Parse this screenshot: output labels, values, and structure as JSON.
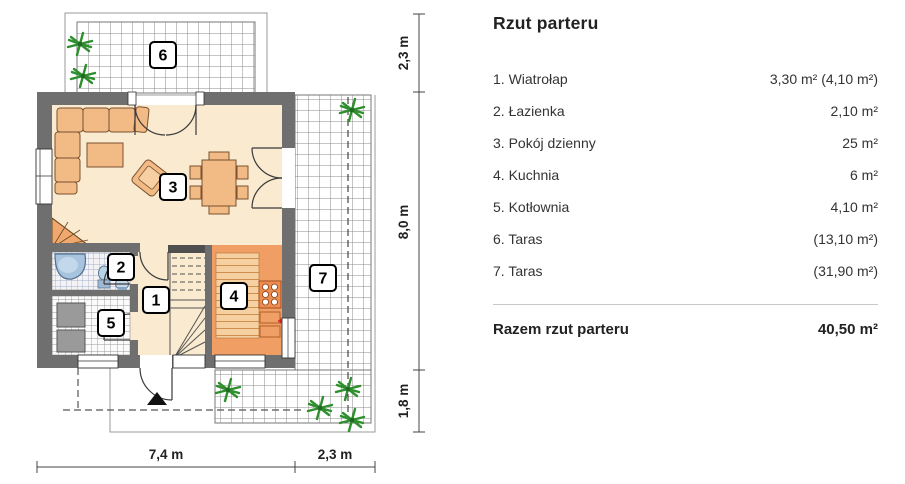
{
  "panel": {
    "title": "Rzut parteru",
    "rows": [
      {
        "label": "1. Wiatrołap",
        "value": "3,30 m² (4,10 m²)"
      },
      {
        "label": "2. Łazienka",
        "value": "2,10 m²"
      },
      {
        "label": "3. Pokój dzienny",
        "value": "25 m²"
      },
      {
        "label": "4. Kuchnia",
        "value": "6 m²"
      },
      {
        "label": "5. Kotłownia",
        "value": "4,10 m²"
      },
      {
        "label": "6. Taras",
        "value": "(13,10 m²)"
      },
      {
        "label": "7. Taras",
        "value": "(31,90 m²)"
      }
    ],
    "total": {
      "label": "Razem rzut parteru",
      "value": "40,50 m²"
    }
  },
  "plan": {
    "rooms": {
      "r1": "1",
      "r2": "2",
      "r3": "3",
      "r4": "4",
      "r5": "5",
      "r6": "6",
      "r7": "7"
    },
    "dims": {
      "right_top": "2,3 m",
      "right_mid": "8,0 m",
      "right_bottom": "1,8 m",
      "bottom_left": "7,4 m",
      "bottom_right": "2,3 m"
    },
    "colors": {
      "wall": "#6f6f6f",
      "floor": "#f9ead0",
      "furniture": "#f2ba85",
      "kitchen_counter": "#f09e63",
      "kitchen_planks": "#f6d0a0",
      "shower_blue": "#a7c3de",
      "plant_green": "#2f8f2f",
      "equipment_gray": "#9a9a9a"
    }
  }
}
